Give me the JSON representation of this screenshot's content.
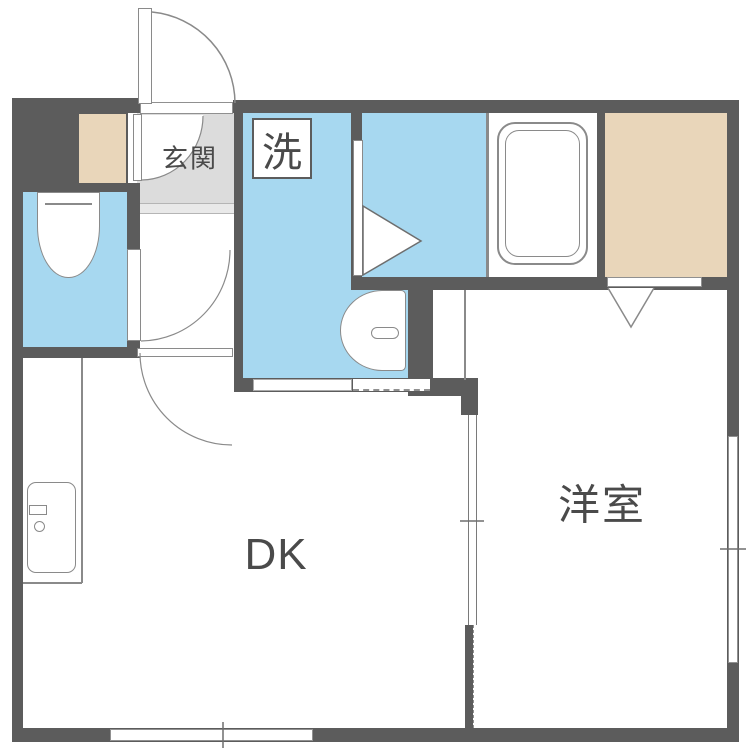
{
  "plan": {
    "labels": {
      "genkan": "玄関",
      "laundry": "洗",
      "dining_kitchen": "DK",
      "western_room": "洋室"
    },
    "colors": {
      "wall": "#5c5c5c",
      "water_area": "#a7d8f0",
      "closet": "#e9d6ba",
      "genkan_floor": "#dcdcdc",
      "genkan_step": "#e9e9e9",
      "line": "#8a8a8a",
      "text": "#4a4a4a",
      "background": "#ffffff"
    },
    "fixtures": [
      "toilet",
      "bathtub",
      "washbasin",
      "kitchen-sink",
      "entrance-door",
      "folding-bath-door",
      "closet-folding-door",
      "sliding-partition",
      "windows"
    ]
  }
}
